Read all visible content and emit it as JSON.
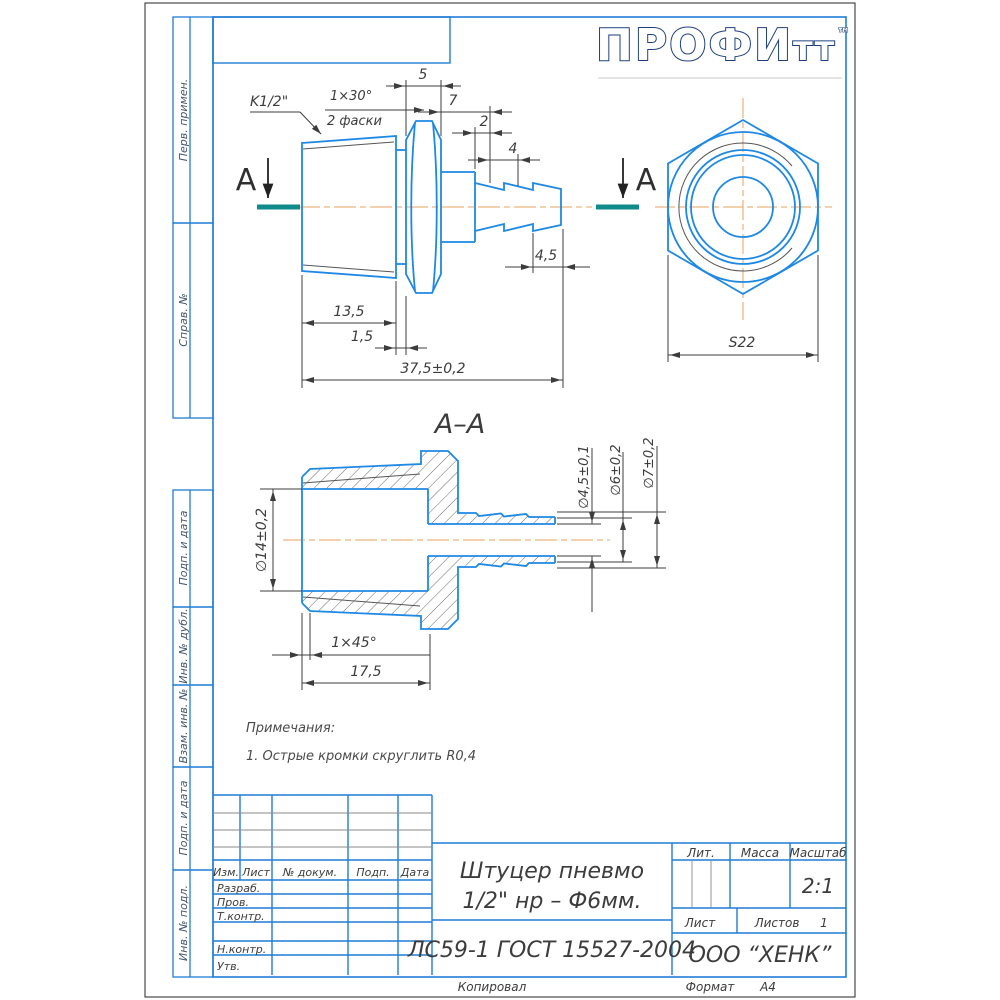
{
  "sheet": {
    "logo_text": "ПРОФИ",
    "logo_text2": "тт",
    "logo_tm": "™",
    "footer_copied": "Копировал",
    "footer_format_label": "Формат",
    "footer_format_value": "А4"
  },
  "margin_labels": {
    "perv_primen": "Перв. примен.",
    "sprav_no": "Справ. №",
    "podp_data_1": "Подп. и дата",
    "inv_no_dubl": "Инв. № дубл.",
    "vzam_inv_no": "Взам. инв. №",
    "podp_data_2": "Подп. и дата",
    "inv_no_podl": "Инв. № подл."
  },
  "drawing": {
    "section_arrow_label": "А",
    "section_title": "А–А",
    "notes_title": "Примечания:",
    "notes_item": "1. Острые кромки скруглить R0,4",
    "dims": {
      "thread": "K1/2\"",
      "chamfer_top_1": "1×30°",
      "chamfer_top_2": "2 фаски",
      "hex_width": "5",
      "len7": "7",
      "len2": "2",
      "len4": "4",
      "len45": "4,5",
      "len135": "13,5",
      "len15": "1,5",
      "total": "37,5±0,2",
      "wrench": "S22",
      "dia14": "∅14±0,2",
      "dia45": "∅4,5±0,1",
      "dia6": "∅6±0,2",
      "dia7": "∅7±0,2",
      "chamfer45": "1×45°",
      "len175": "17,5"
    }
  },
  "title_block": {
    "rev_headers": [
      "Изм.",
      "Лист",
      "№ докум.",
      "Подп.",
      "Дата"
    ],
    "sign_labels": [
      "Разраб.",
      "Пров.",
      "Т.контр.",
      "Н.контр.",
      "Утв."
    ],
    "doc_name_1": "Штуцер пневмо",
    "doc_name_2": "1/2\" нр – Ф6мм.",
    "material": "ЛС59-1 ГОСТ 15527-2004",
    "lit_label": "Лит.",
    "mass_label": "Масса",
    "scale_label": "Масштаб",
    "scale_value": "2:1",
    "sheet_label": "Лист",
    "sheets_label": "Листов",
    "sheets_value": "1",
    "company": "ООО “ХЕНК”"
  },
  "colors": {
    "frame_blue": "#1f7dd6",
    "part_blue": "#1e88e5",
    "dim_gray": "#3c3c3c",
    "centerline_orange": "#e8a35c",
    "section_teal": "#0f8b8b",
    "logo_navy": "#1c3f7d"
  }
}
